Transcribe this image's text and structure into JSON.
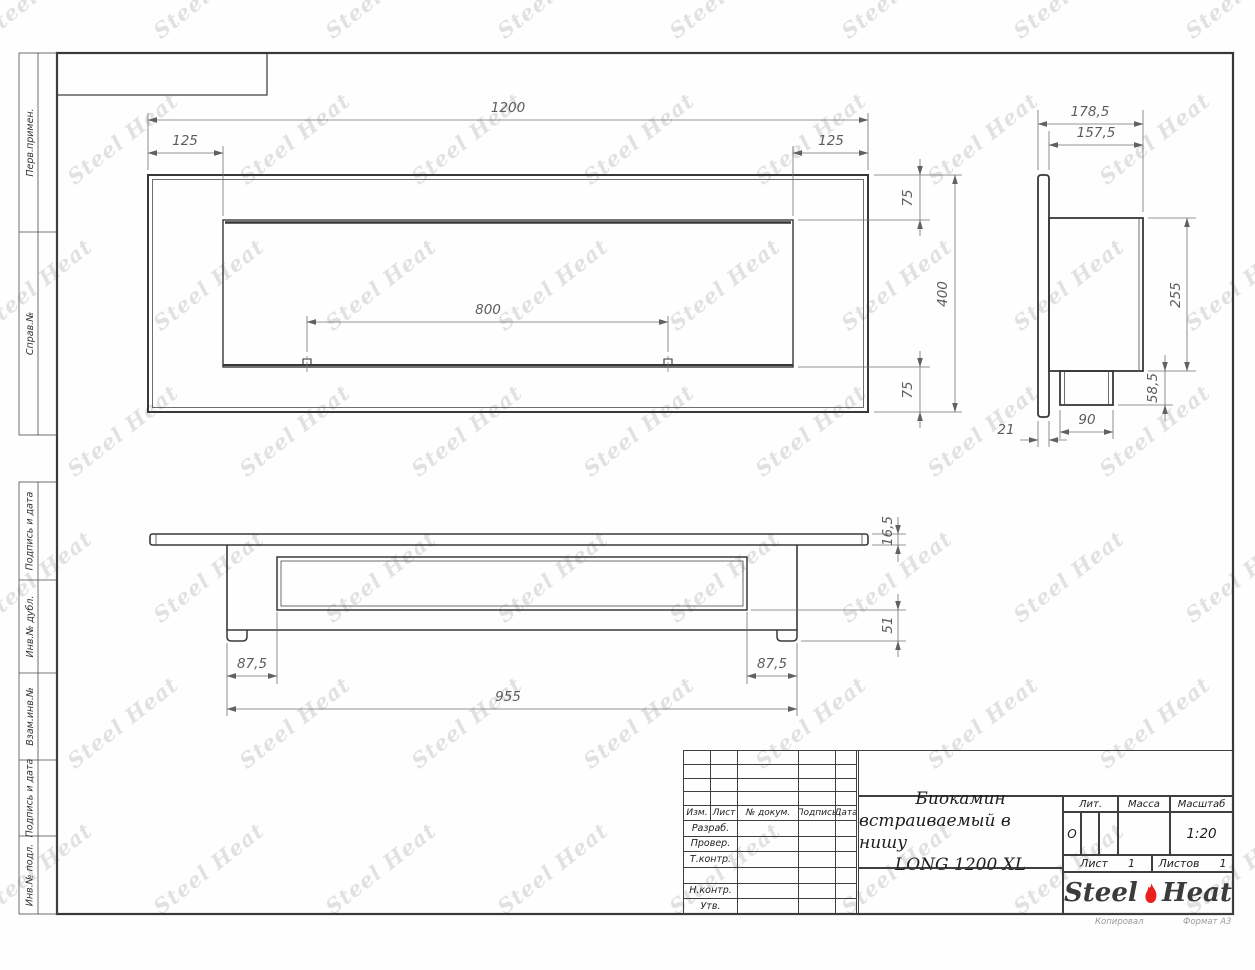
{
  "watermark": {
    "text": "Steel Heat"
  },
  "colors": {
    "line": "#383838",
    "dim_line": "#707070",
    "dim_text": "#5c5c5c",
    "accent_red": "#e8211d",
    "watermark": "#9e9e9e"
  },
  "left_strip": {
    "items": [
      {
        "label": "Перв.примен."
      },
      {
        "label": "Справ.№"
      },
      {
        "label": "Подпись и дата"
      },
      {
        "label": "Инв.№ дубл."
      },
      {
        "label": "Взам.инв.№"
      },
      {
        "label": "Подпись и дата"
      },
      {
        "label": "Инв.№ подл."
      }
    ]
  },
  "views": {
    "front": {
      "dims": {
        "width_total": "1200",
        "offset_left": "125",
        "offset_right": "125",
        "opening_width": "800",
        "margin_top": "75",
        "height_total": "400",
        "margin_bottom": "75"
      }
    },
    "side": {
      "dims": {
        "depth_total": "178,5",
        "depth_body": "157,5",
        "height_body": "255",
        "burner_height": "58,5",
        "burner_width": "90",
        "flange_thickness": "21"
      }
    },
    "bottom": {
      "dims": {
        "flange_thickness": "16,5",
        "bottom_clearance": "51",
        "inset_left": "87,5",
        "inset_right": "87,5",
        "body_width": "955"
      }
    }
  },
  "title_block": {
    "rev_headers": {
      "izm": "Изм.",
      "list": "Лист",
      "doc": "№ докум.",
      "podpis": "Подпись",
      "date": "Дата"
    },
    "role_rows": [
      {
        "label": "Разраб."
      },
      {
        "label": "Провер."
      },
      {
        "label": "Т.контр."
      },
      {
        "label": ""
      },
      {
        "label": "Н.контр."
      },
      {
        "label": "Утв."
      }
    ],
    "title_line1": "Биокамин",
    "title_line2": "встраиваемый в нишу",
    "title_line3": "LONG 1200 XL",
    "lit": {
      "label": "Лит.",
      "value": "О"
    },
    "massa": {
      "label": "Масса",
      "value": ""
    },
    "masshtab": {
      "label": "Масштаб",
      "value": "1:20"
    },
    "sheet_no": {
      "label": "Лист",
      "value": "1"
    },
    "sheets_total": {
      "label": "Листов",
      "value": "1"
    },
    "logo": {
      "word1": "Steel",
      "word2": "Heat"
    }
  },
  "footer": {
    "copy_label": "Копировал",
    "format_label": "Формат А3"
  }
}
